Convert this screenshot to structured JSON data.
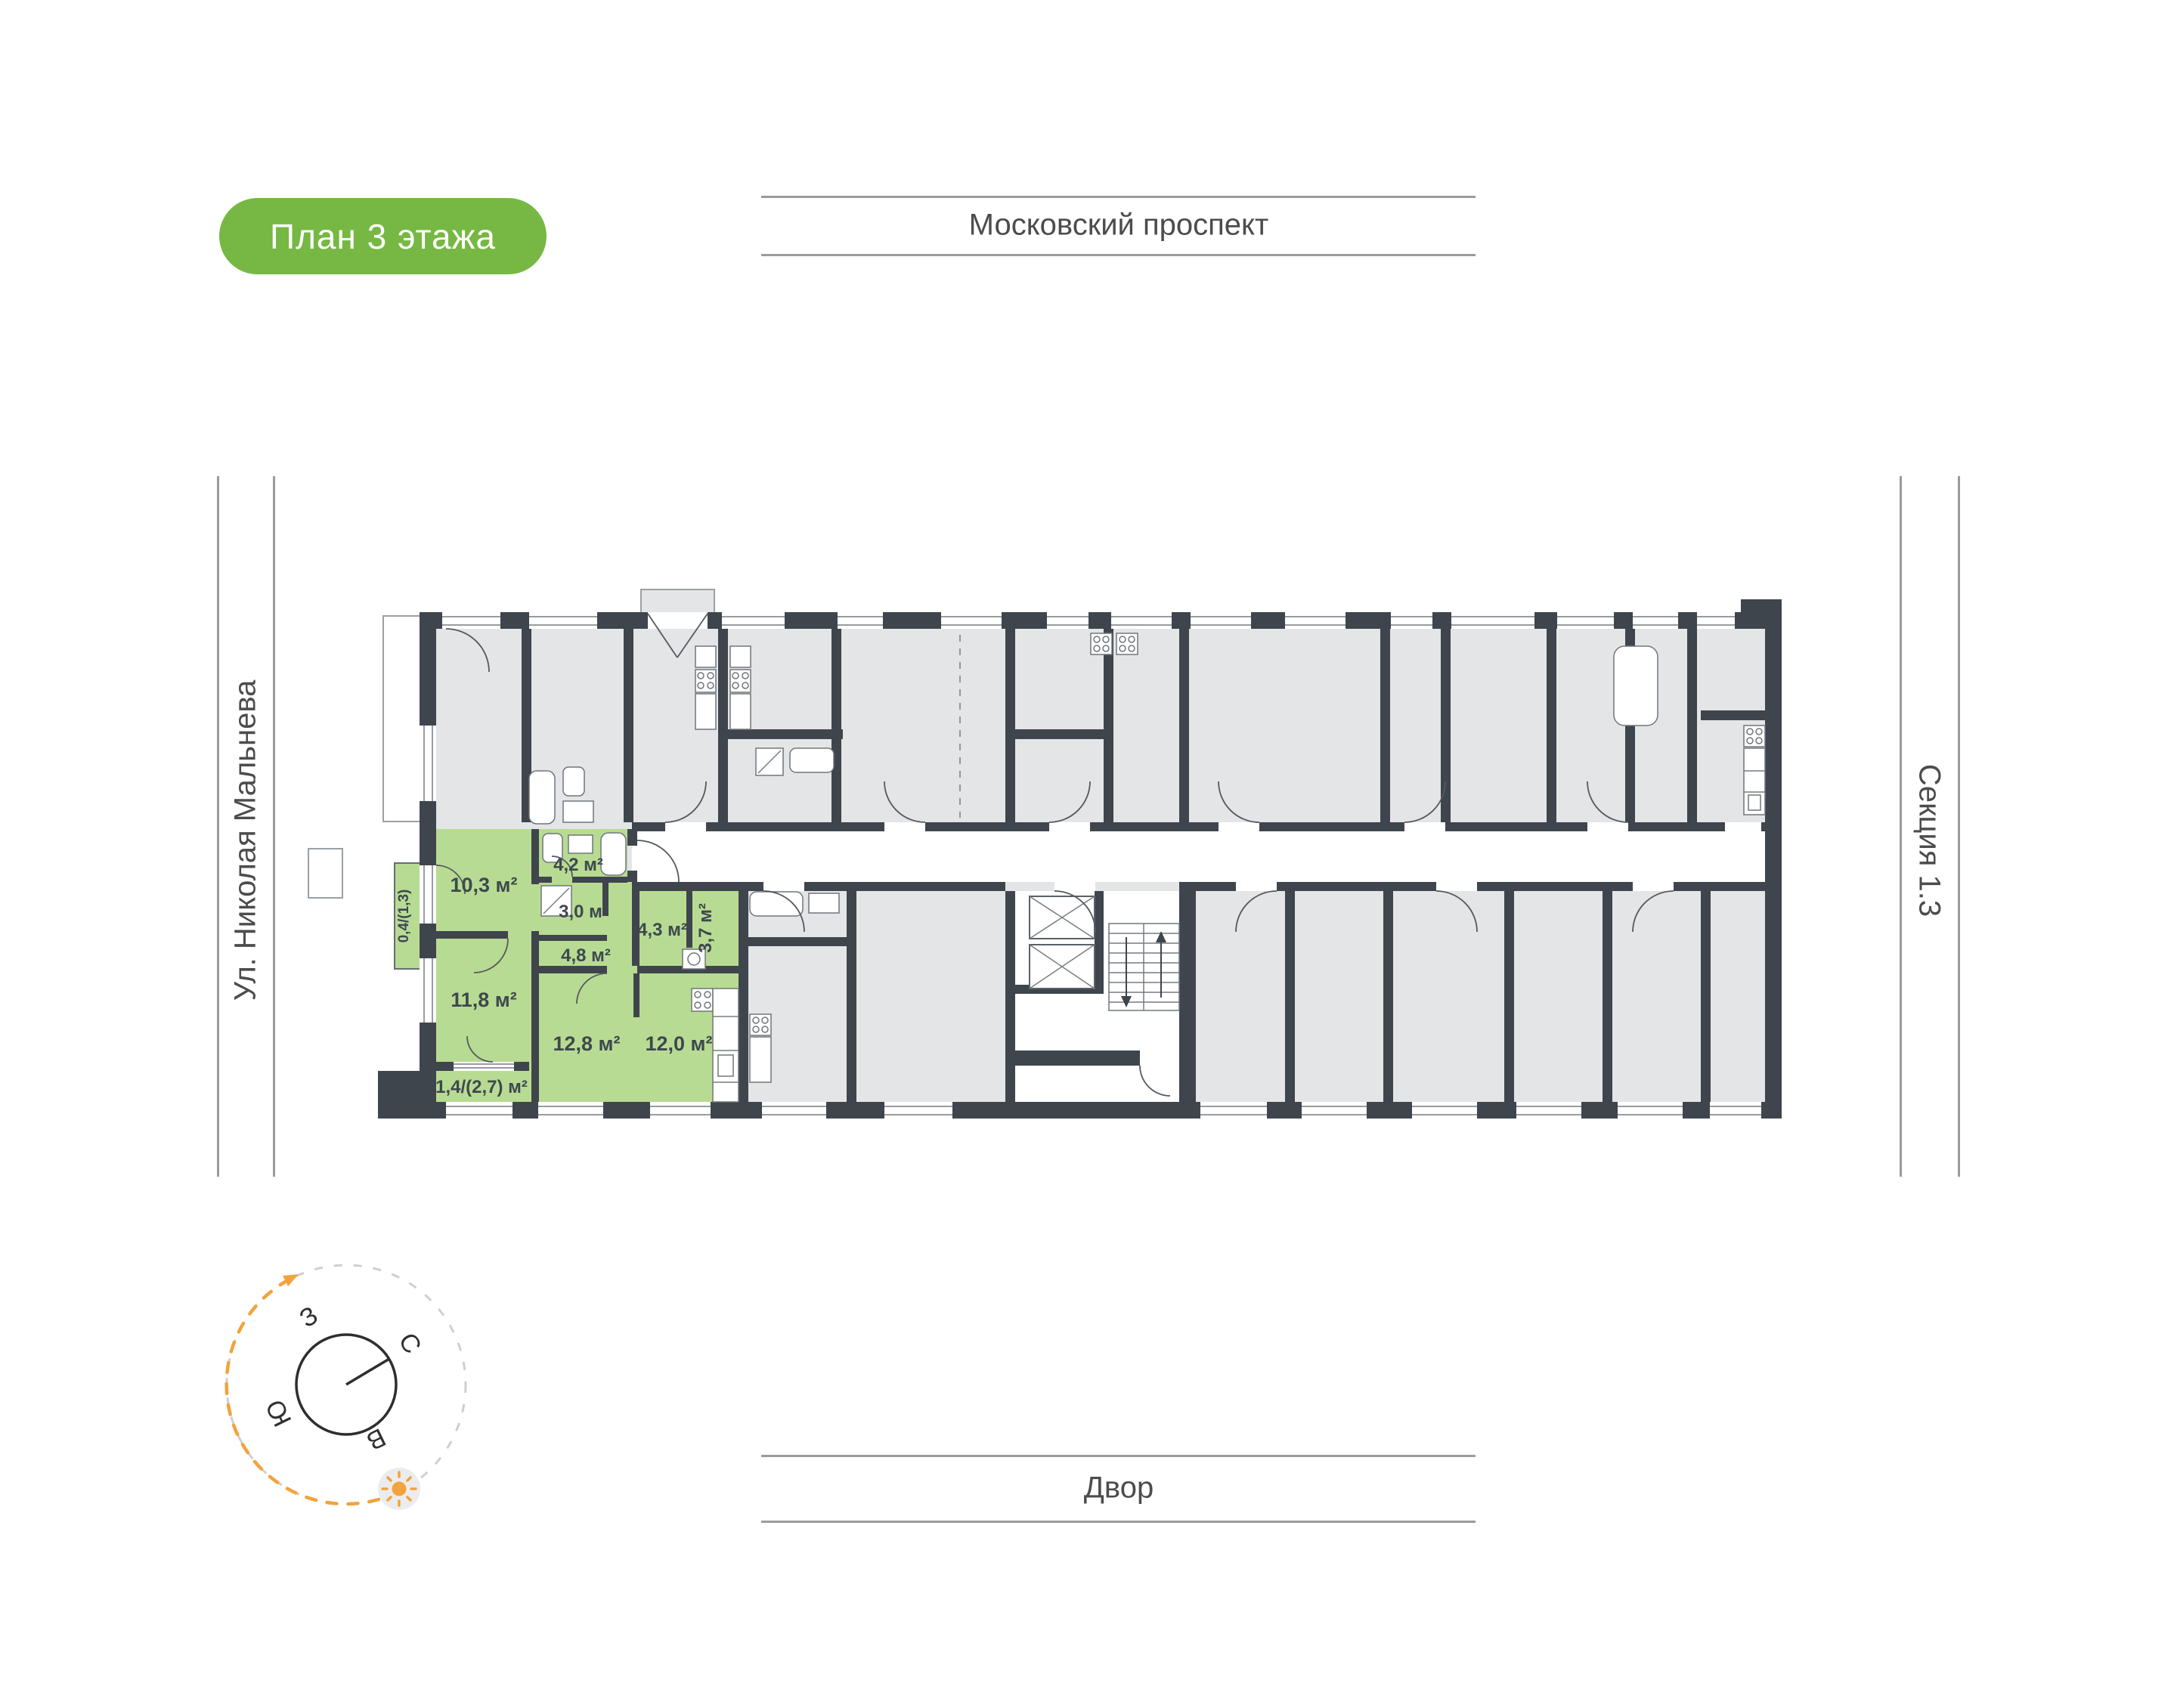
{
  "badge": {
    "label": "План 3 этажа"
  },
  "surroundings": {
    "top": "Московский проспект",
    "left": "Ул. Николая Мальнева",
    "right": "Секция 1.3",
    "bottom": "Двор"
  },
  "compass": {
    "west": "З",
    "north": "С",
    "south": "Ю",
    "east": "В"
  },
  "apartment": {
    "highlighted": true,
    "rooms": [
      {
        "name": "hallway",
        "area": "10,3 м²"
      },
      {
        "name": "bathroom",
        "area": "4,2 м²"
      },
      {
        "name": "wc",
        "area": "3,0 м²"
      },
      {
        "name": "inner-corridor",
        "area": "4,8 м²"
      },
      {
        "name": "storage",
        "area": "4,3 м²"
      },
      {
        "name": "bathroom-2",
        "area": "3,7 м²"
      },
      {
        "name": "bedroom",
        "area": "11,8 м²"
      },
      {
        "name": "living-room",
        "area": "12,8 м²"
      },
      {
        "name": "kitchen",
        "area": "12,0 м²"
      },
      {
        "name": "balcony",
        "area": "1,4/(2,7) м²"
      },
      {
        "name": "balcony-small",
        "area": "0,4/(1,3)"
      }
    ]
  },
  "colors": {
    "accent_green": "#76b843",
    "apartment_green": "#b8db93",
    "wall": "#3f454c",
    "room_gray": "#e4e5e7",
    "compass_orange": "#f2a33c",
    "line_gray": "#9b9b9b",
    "label_text": "#3e484e",
    "street_text": "#4c4c4c"
  }
}
